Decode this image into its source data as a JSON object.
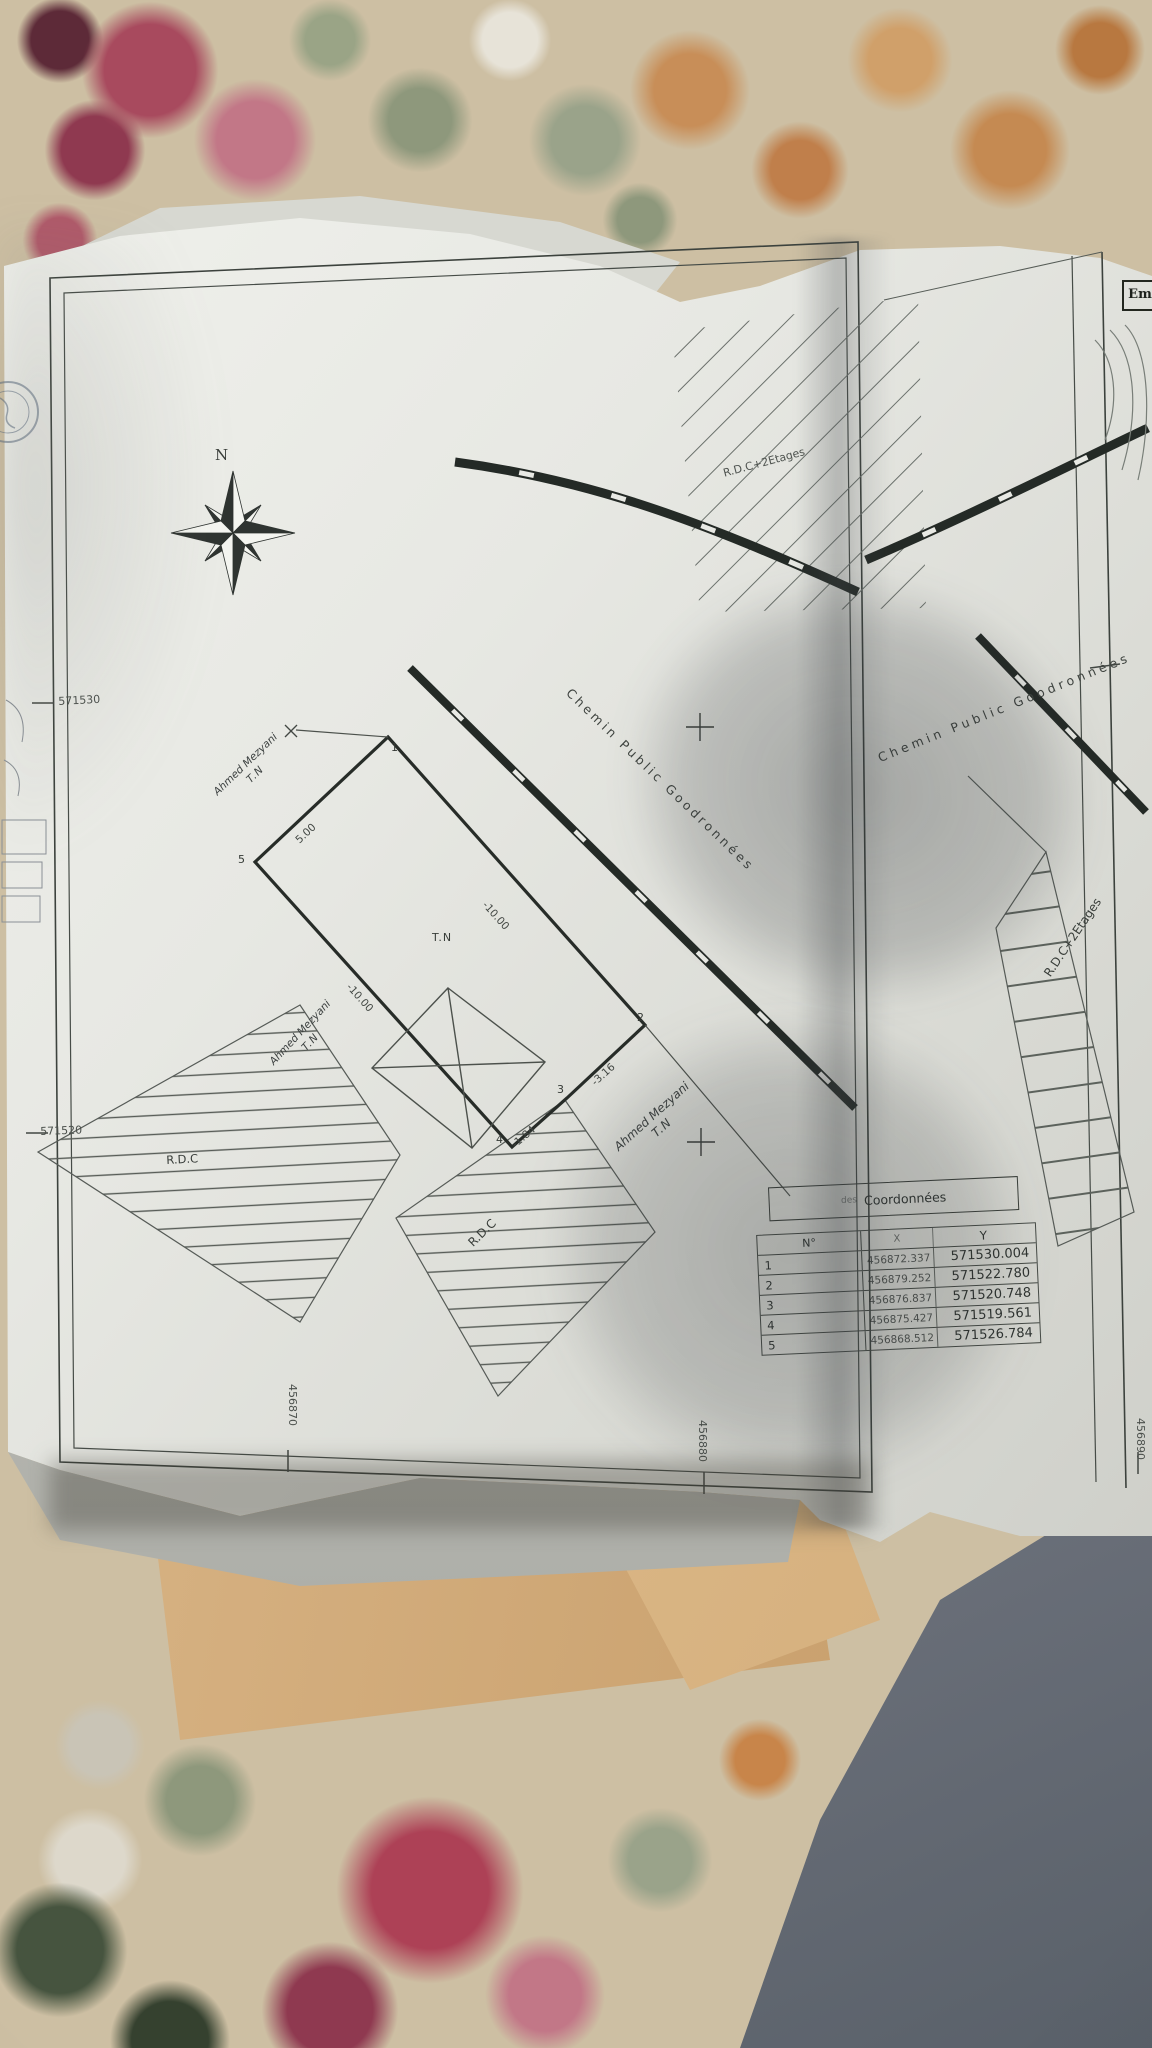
{
  "plan": {
    "compass_label": "N",
    "corner_box_label": "Em",
    "roads": {
      "chemin_left": "Chemin Public Goodronnées",
      "chemin_right": "Chemin Public Goodronnées"
    },
    "buildings": {
      "rdc_plus2_top": "R.D.C+2Etages",
      "rdc_plus2_right": "R.D.C+2Etages",
      "rdc_bottom_left": "R.D.C",
      "rdc_bottom_center": "R.D.C"
    },
    "owners": {
      "owner_top": {
        "name": "Ahmed Mezyani",
        "note": "T.N"
      },
      "owner_left": {
        "name": "Ahmed Mezyani",
        "note": "T.N"
      },
      "owner_bottom": {
        "name": "Ahmed Mezyani",
        "note": "T.N"
      }
    },
    "terrain_note": "T.N",
    "parcel": {
      "corner_labels": [
        "1",
        "2",
        "3",
        "4",
        "5"
      ],
      "dim_edge_5_1": "5.00",
      "dim_edge_1_2": "-10.00",
      "dim_edge_2_3": "-3.16",
      "dim_edge_3_4": "-1.84",
      "dim_edge_4_5": "-10.00"
    },
    "grid": {
      "left_labels": [
        "571530",
        "571520"
      ],
      "bottom_labels": [
        "456870",
        "456880",
        "456890"
      ]
    }
  },
  "coordinates_table": {
    "title_prefix": "des",
    "title": "Coordonnées",
    "headers": [
      "N°",
      "X",
      "Y"
    ],
    "rows": [
      [
        "1",
        "456872.337",
        "571530.004"
      ],
      [
        "2",
        "456879.252",
        "571522.780"
      ],
      [
        "3",
        "456876.837",
        "571520.748"
      ],
      [
        "4",
        "456875.427",
        "571519.561"
      ],
      [
        "5",
        "456868.512",
        "571526.784"
      ]
    ]
  }
}
